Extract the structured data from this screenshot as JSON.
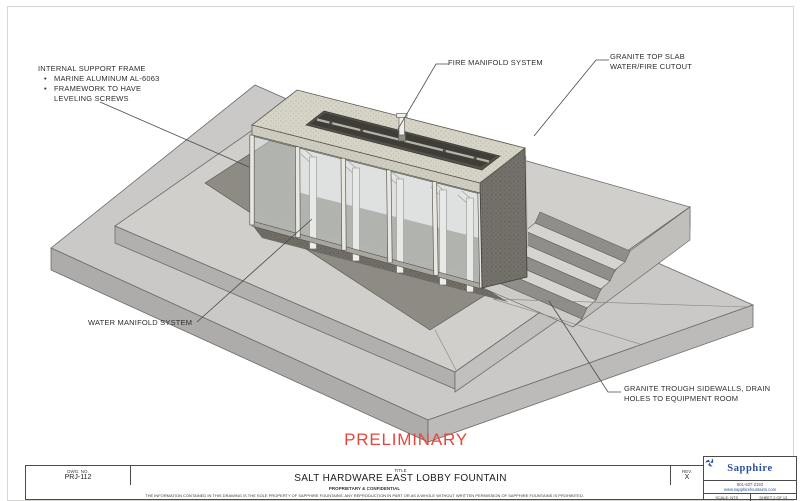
{
  "sheet": {
    "watermark": "PRELIMINARY",
    "callouts": {
      "internal_support_frame": {
        "title": "INTERNAL SUPPORT FRAME",
        "bullets": [
          "MARINE ALUMINUM AL-6063",
          "FRAMEWORK TO HAVE LEVELING SCREWS"
        ]
      },
      "fire_manifold": "FIRE MANIFOLD SYSTEM",
      "granite_top_slab": "GRANITE TOP SLAB WATER/FIRE CUTOUT",
      "water_manifold": "WATER MANIFOLD SYSTEM",
      "granite_trough": "GRANITE TROUGH SIDEWALLS, DRAIN HOLES TO EQUIPMENT ROOM"
    }
  },
  "title_block": {
    "dwg_label": "DWG. NO.",
    "dwg_no": "PRJ-112",
    "title_label": "TITLE",
    "title": "SALT HARDWARE EAST LOBBY FOUNTAIN",
    "proprietary": "PROPRIETARY & CONFIDENTIAL",
    "legal": "THE INFORMATION CONTAINED IN THIS DRAWING IS THE SOLE PROPERTY OF SAPPHIRE FOUNTAINS.  ANY REPRODUCTION IN PART OR AS A WHOLE WITHOUT WRITTEN PERMISSION OF SAPPHIRE FOUNTAINS IS PROHIBITED.",
    "rev_label": "REV.",
    "rev_value": "X",
    "scale": "SCALE: NTS",
    "sheet_no": "SHEET 2 OF 13",
    "company": {
      "name": "Sapphire",
      "phone": "801-637-2193",
      "website": "www.sapphirefountains.com"
    }
  },
  "colors": {
    "preliminary_red": "#e4473b",
    "logo_blue": "#2a4f9f",
    "drawing_line": "#4a4a46"
  }
}
